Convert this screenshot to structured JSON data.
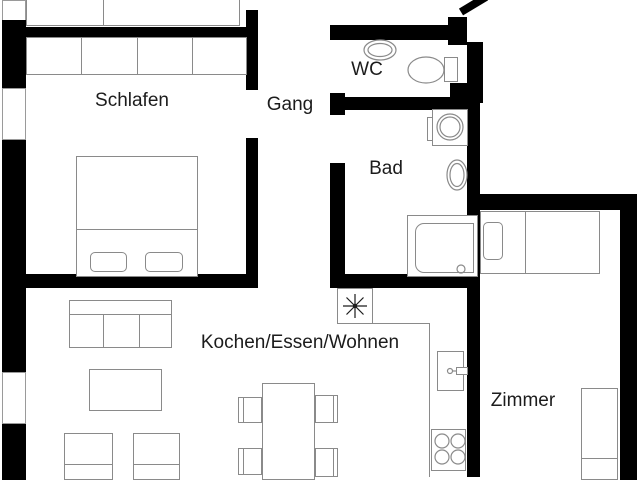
{
  "title": "Apartment floor plan",
  "colors": {
    "wall": "#000000",
    "line": "#8a8a8a",
    "text": "#1c1c1c",
    "bg": "#ffffff"
  },
  "rooms": {
    "schlafen": {
      "label": "Schlafen"
    },
    "gang": {
      "label": "Gang"
    },
    "wc": {
      "label": "WC"
    },
    "bad": {
      "label": "Bad"
    },
    "wohnen": {
      "label": "Kochen/Essen/Wohnen"
    },
    "zimmer": {
      "label": "Zimmer"
    }
  },
  "fixtures": [
    {
      "id": "wardrobe",
      "room": "schlafen"
    },
    {
      "id": "double-bed",
      "room": "schlafen"
    },
    {
      "id": "washbasin",
      "room": "wc"
    },
    {
      "id": "toilet",
      "room": "wc"
    },
    {
      "id": "washing-machine",
      "room": "bad"
    },
    {
      "id": "washbasin",
      "room": "bad"
    },
    {
      "id": "shower",
      "room": "bad"
    },
    {
      "id": "ceiling-light",
      "room": "wohnen"
    },
    {
      "id": "kitchen-sink",
      "room": "wohnen"
    },
    {
      "id": "stove",
      "room": "wohnen"
    },
    {
      "id": "sofa",
      "room": "wohnen"
    },
    {
      "id": "coffee-table",
      "room": "wohnen"
    },
    {
      "id": "armchair",
      "room": "wohnen"
    },
    {
      "id": "armchair",
      "room": "wohnen"
    },
    {
      "id": "dining-table",
      "room": "wohnen"
    },
    {
      "id": "chair",
      "room": "wohnen"
    },
    {
      "id": "chair",
      "room": "wohnen"
    },
    {
      "id": "chair",
      "room": "wohnen"
    },
    {
      "id": "chair",
      "room": "wohnen"
    },
    {
      "id": "single-bed",
      "room": "zimmer"
    },
    {
      "id": "desk",
      "room": "zimmer"
    },
    {
      "id": "entrance-door",
      "room": "gang"
    },
    {
      "id": "window",
      "room": "schlafen"
    },
    {
      "id": "window",
      "room": "wohnen"
    }
  ]
}
